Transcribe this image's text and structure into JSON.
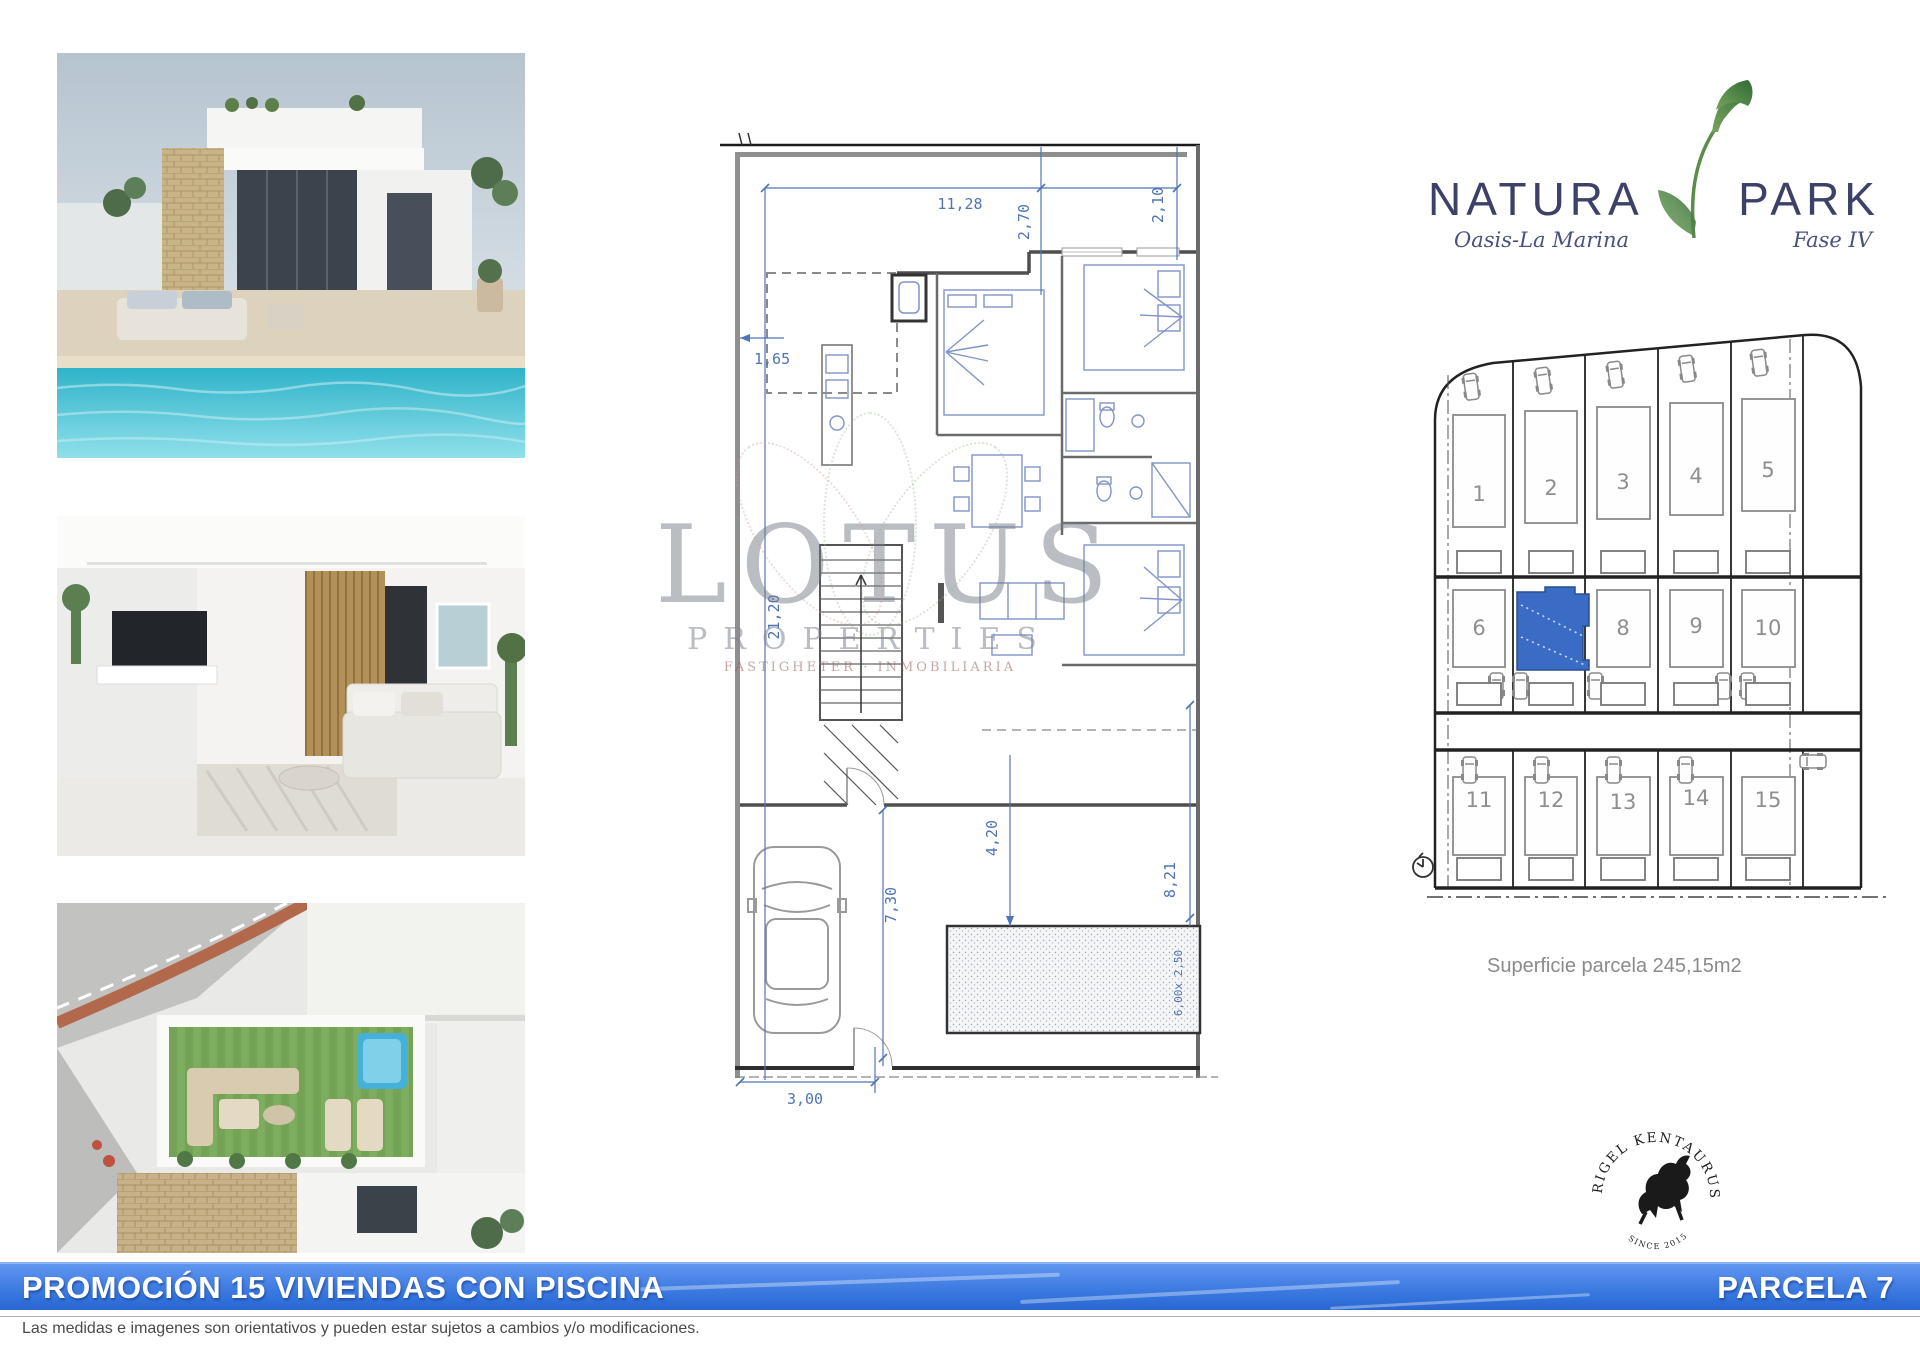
{
  "brand": {
    "name_left": "NATURA",
    "name_right": "PARK",
    "tagline_left": "Oasis-La Marina",
    "tagline_right": "Fase IV",
    "navy": "#3d4168",
    "green": "#4f7d3c"
  },
  "floor_plan": {
    "dim_color": "#4f74b8",
    "dims": {
      "top_width": "11,28",
      "top_depth1": "2,70",
      "top_depth2": "2,10",
      "left_offset": "1,65",
      "plot_depth": "21,20",
      "pool_offset": "4,20",
      "garden_depth": "7,30",
      "right_depth": "8,21",
      "pool_size": "6,00x 2,50",
      "entry_width": "3,00"
    }
  },
  "watermark": {
    "title": "LOTUS",
    "subtitle": "PROPERTIES",
    "tagline": "FASTIGHETER · INMOBILIARIA"
  },
  "site_plan": {
    "plots": [
      "1",
      "2",
      "3",
      "4",
      "5",
      "6",
      "7",
      "8",
      "9",
      "10",
      "11",
      "12",
      "13",
      "14",
      "15"
    ],
    "highlighted_plot": "7",
    "highlight_color": "#3b6cc5",
    "caption": "Superficie parcela 245,15m2"
  },
  "stamp": {
    "arc_text": "RIGEL KENTAURUS",
    "since_text": "SINCE 2015"
  },
  "footer": {
    "bar_title": "PROMOCIÓN 15 VIVIENDAS CON PISCINA",
    "bar_parcel": "PARCELA 7",
    "bar_color": "#3a78e0",
    "disclaimer": "Las medidas e imagenes son orientativos y pueden estar sujetos a cambios y/o modificaciones."
  }
}
